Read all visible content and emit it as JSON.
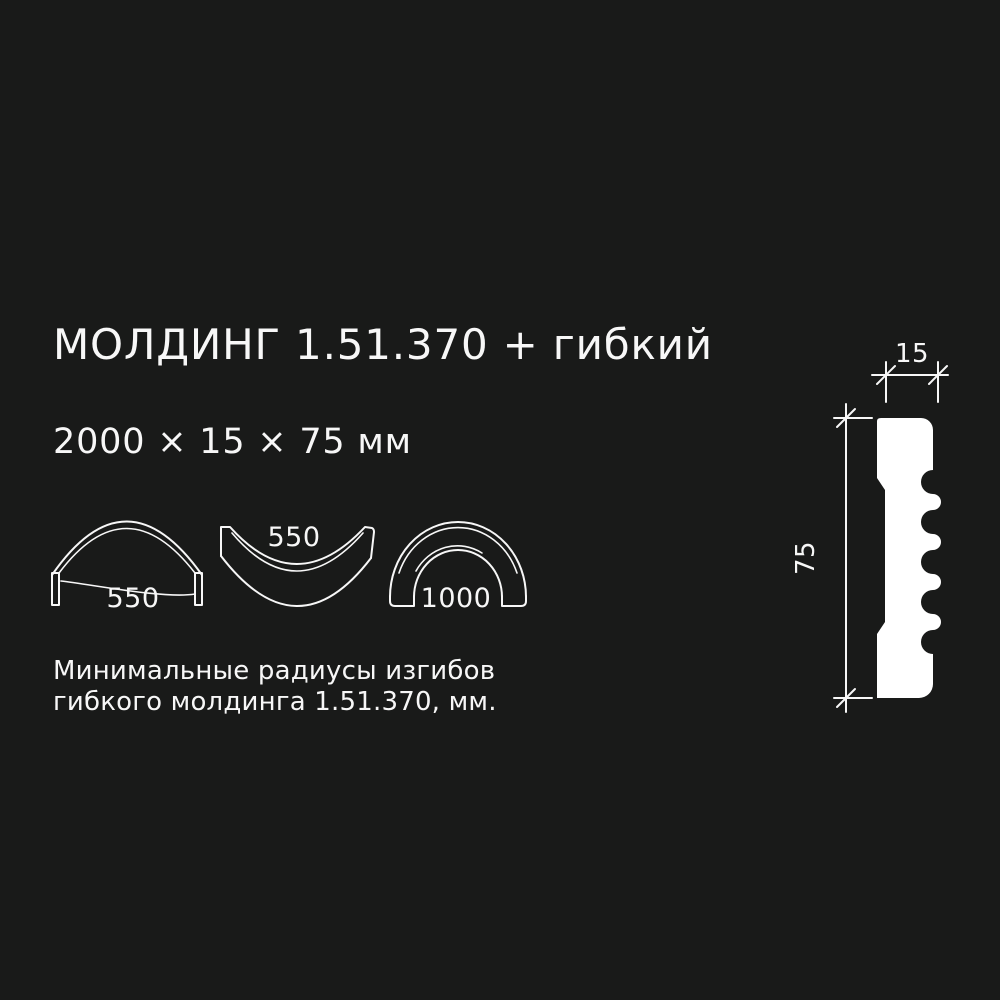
{
  "colors": {
    "background": "#191a19",
    "foreground": "#f7f7f7",
    "profile_fill": "#ffffff"
  },
  "header": {
    "title": "МОЛДИНГ 1.51.370 + гибкий",
    "size_line": "2000 × 15 × 75 мм"
  },
  "bend_radii": {
    "caption": [
      "Минимальные радиусы изгибов",
      "гибкого молдинга 1.51.370, мм."
    ],
    "shapes": [
      {
        "type": "arch-face-outward",
        "radius_label": "550"
      },
      {
        "type": "trough-face-upward",
        "radius_label": "550"
      },
      {
        "type": "arch-on-edge",
        "radius_label": "1000"
      }
    ]
  },
  "profile_drawing": {
    "width_mm": "15",
    "height_mm": "75"
  }
}
